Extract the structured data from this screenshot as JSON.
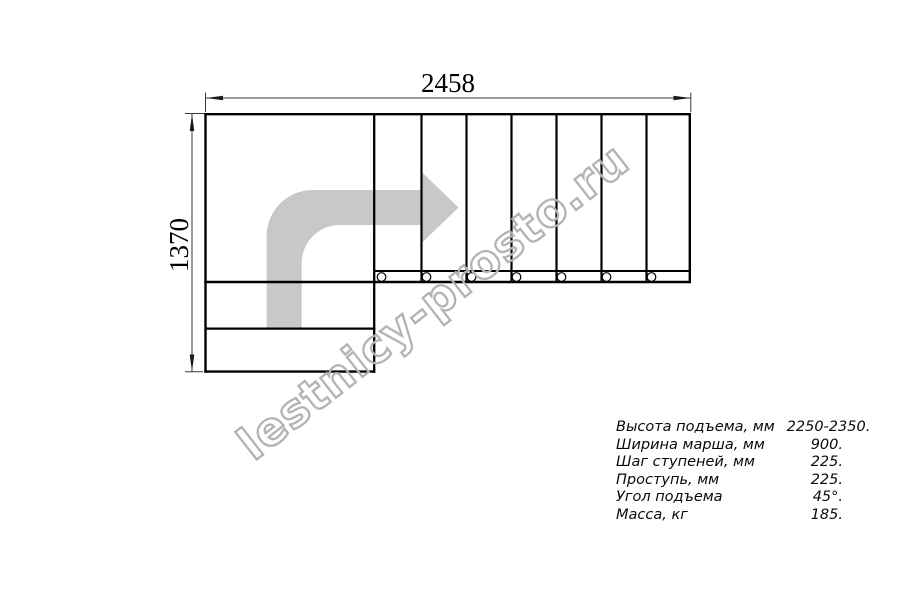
{
  "drawing": {
    "title": "L-shaped staircase top-view plan",
    "width_dim": "2458",
    "height_dim": "1370",
    "watermark": "lestnicy-prosto.ru",
    "colors": {
      "line": "#000000",
      "dimension_line": "#3a3a3a",
      "arrow_fill": "#c8c8c8",
      "watermark_stroke": "#b3b3b3",
      "background": "#ffffff"
    }
  },
  "specs": {
    "rows": [
      {
        "label": "Высота подъема, мм",
        "value": "2250-2350."
      },
      {
        "label": "Ширина марша, мм",
        "value": "900."
      },
      {
        "label": "Шаг ступеней, мм",
        "value": "225."
      },
      {
        "label": "Проступь, мм",
        "value": "225."
      },
      {
        "label": "Угол подъема",
        "value": "45°."
      },
      {
        "label": "Масса, кг",
        "value": "185."
      }
    ]
  }
}
